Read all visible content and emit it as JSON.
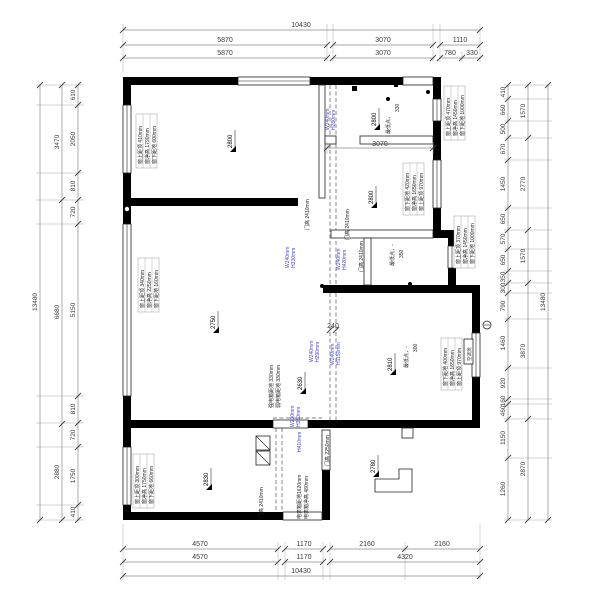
{
  "drawing": {
    "type": "residential floor plan (original structure survey)",
    "units": "mm",
    "colors": {
      "wall": "#000000",
      "beam_label": "#4343c8",
      "dimension": "#555555"
    },
    "dims_top": {
      "overall": "10430",
      "row2": [
        "5870",
        "3070",
        "1110"
      ],
      "row3": [
        "5870",
        "3070",
        "780",
        "330"
      ]
    },
    "dims_bottom": {
      "row1": [
        "4570",
        "1170",
        "2160",
        "2160"
      ],
      "row2": [
        "4570",
        "1170",
        "4320"
      ],
      "overall": "10430"
    },
    "dims_left": {
      "overall": "13480",
      "mid": [
        "3470",
        "6680",
        "2880"
      ],
      "inner": [
        "610",
        "2050",
        "810",
        "720",
        "5150",
        "810",
        "720",
        "1750",
        "410"
      ]
    },
    "dims_right": {
      "overall": "13480",
      "mid": [
        "1570",
        "2770",
        "1570",
        "3870",
        "2870"
      ],
      "inner": [
        "410",
        "660",
        "500",
        "670",
        "1450",
        "650",
        "570",
        "650",
        "350",
        "300",
        "790",
        "1460",
        "920",
        "160",
        "460",
        "1150",
        "1260"
      ]
    },
    "dims_interior": {
      "room_width": "3070",
      "beam_width": "240"
    },
    "ceiling_heights": [
      "2800",
      "2800",
      "2800",
      "2750",
      "2630",
      "2810",
      "2830",
      "2780"
    ],
    "low_points": [
      {
        "label": "最低点，",
        "value": "330"
      },
      {
        "label": "最低点，-",
        "value": "350"
      },
      {
        "label": "最低点，-",
        "value": "300"
      }
    ],
    "windows": [
      {
        "l1": "窗上距顶 410mm",
        "l2": "窗净高 1790mm",
        "l3": "窗下距地 600mm"
      },
      {
        "l1": "窗上距顶 470mm",
        "l2": "窗净高 1450mm",
        "l3": "窗下距地 1000mm"
      },
      {
        "l1": "窗下距地 420mm",
        "l2": "窗净高 1650mm",
        "l3": "窗上距顶 970mm"
      },
      {
        "l1": "窗上距顶 370mm",
        "l2": "窗净高 1450mm",
        "l3": "窗下距地 1000mm"
      },
      {
        "l1": "窗上距顶 340mm",
        "l2": "窗净高 2250mm",
        "l3": "窗下距地 160mm"
      },
      {
        "l1": "窗下距地 400mm",
        "l2": "窗净高 1650mm",
        "l3": "窗上距顶 970mm"
      },
      {
        "l1": "窗上距顶 300mm",
        "l2": "窗净高 1750mm",
        "l3": "窗下距地 660mm"
      }
    ],
    "doors": [
      "门高 2410mm",
      "门高 2410mm",
      "门高 2410mm",
      "门高 2410mm",
      "门高 2250mm"
    ],
    "beams": [
      {
        "w": "W240mm",
        "h": "H280mm"
      },
      {
        "w": "W240mm",
        "h": "H330mm"
      },
      {
        "w": "W240mm",
        "h": "H420mm"
      },
      {
        "w": "W240mm",
        "h": "H290mm"
      },
      {
        "w": "W240mm",
        "h": "H1150mm"
      },
      {
        "w": "W230mm",
        "h": "H330mm"
      },
      {
        "w": "",
        "h": "H410mm"
      }
    ],
    "equipment": {
      "strong_box": "强电箱距地 330mm",
      "weak_box": "弱电箱距地 330mm",
      "meter_box_1": "电表箱距地1620mm",
      "meter_box_2": "电表箱净高 480mm",
      "ac_hole": "空调洞"
    }
  }
}
